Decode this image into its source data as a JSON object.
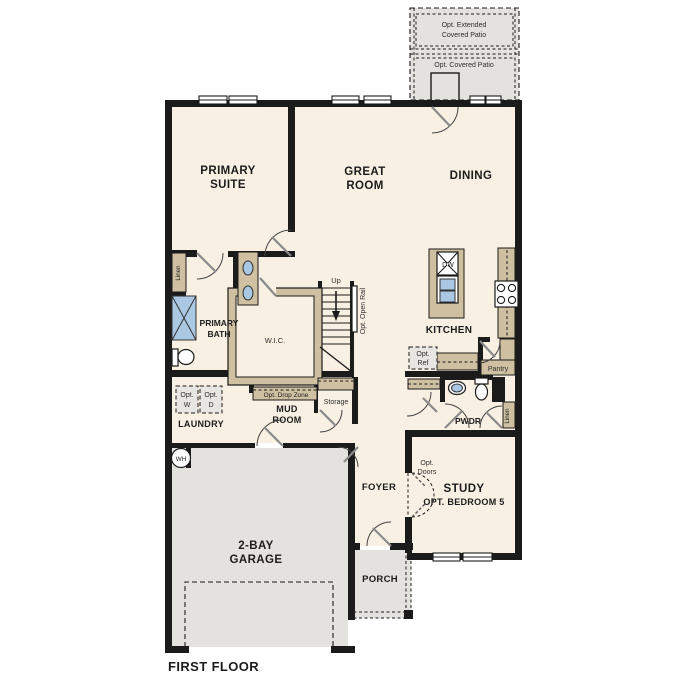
{
  "plan_title": "FIRST FLOOR",
  "colors": {
    "wall": "#1b1b1b",
    "interior": "#f8f0e2",
    "exterior_concrete": "#e3e2df",
    "cabinetry_tan": "#cfc0a2",
    "fixture_blue": "#aac8e4",
    "background": "#ffffff"
  },
  "rooms": {
    "primary_suite": {
      "l1": "PRIMARY",
      "l2": "SUITE"
    },
    "great_room": {
      "l1": "GREAT",
      "l2": "ROOM"
    },
    "dining": {
      "l1": "DINING"
    },
    "kitchen": {
      "l1": "KITCHEN"
    },
    "primary_bath": {
      "l1": "PRIMARY",
      "l2": "BATH"
    },
    "wic": {
      "l1": "W.I.C."
    },
    "mud_room": {
      "l1": "MUD",
      "l2": "ROOM"
    },
    "laundry": {
      "l1": "LAUNDRY"
    },
    "foyer": {
      "l1": "FOYER"
    },
    "study": {
      "l1": "STUDY",
      "l2": "OPT. BEDROOM 5"
    },
    "pwdr": {
      "l1": "PWDR"
    },
    "porch": {
      "l1": "PORCH"
    },
    "garage": {
      "l1": "2-BAY",
      "l2": "GARAGE"
    }
  },
  "annotations": {
    "patio_extended": {
      "l1": "Opt. Extended",
      "l2": "Covered Patio"
    },
    "patio_covered": "Opt. Covered Patio",
    "up": "Up",
    "open_rail": "Opt. Open Rail",
    "drop_zone": "Opt. Drop Zone",
    "storage": "Storage",
    "pantry": "Pantry",
    "linen_left": "Linen",
    "linen_right": "Linen",
    "opt_w": {
      "l1": "Opt.",
      "l2": "W"
    },
    "opt_d": {
      "l1": "Opt.",
      "l2": "D"
    },
    "opt_ref": {
      "l1": "Opt.",
      "l2": "Ref"
    },
    "opt_doors": {
      "l1": "Opt.",
      "l2": "Doors"
    },
    "water_heater": "WH",
    "dishwasher": "DW"
  }
}
